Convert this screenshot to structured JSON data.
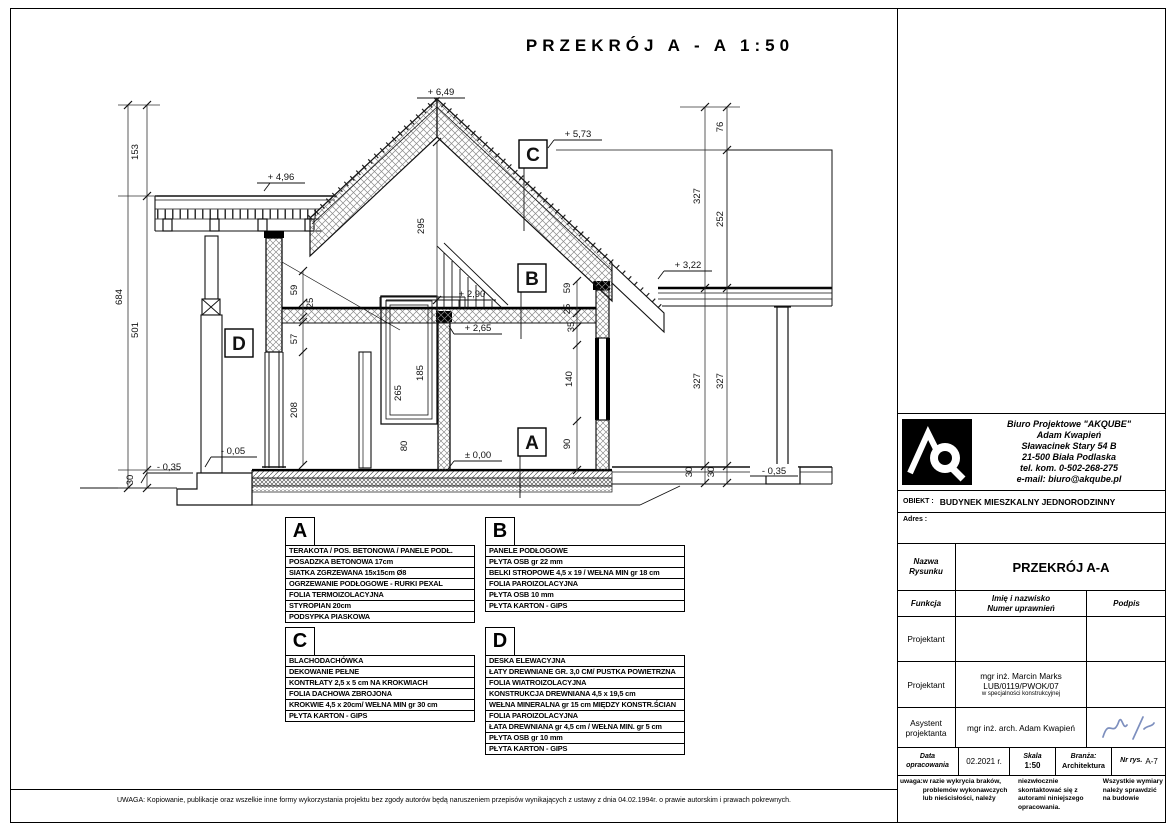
{
  "page": {
    "title": "PRZEKRÓJ  A - A    1:50",
    "footer_note": "UWAGA: Kopiowanie, publikacje oraz wszelkie inne formy wykorzystania projektu bez zgody autorów będą naruszeniem przepisów wynikających z ustawy z dnia 04.02.1994r. o prawie autorskim i prawach pokrewnych."
  },
  "drawing": {
    "callouts": [
      {
        "letter": "A",
        "x": 518,
        "y": 428
      },
      {
        "letter": "B",
        "x": 518,
        "y": 264
      },
      {
        "letter": "C",
        "x": 519,
        "y": 140
      },
      {
        "letter": "D",
        "x": 225,
        "y": 329
      }
    ],
    "labels": [
      {
        "t": "+ 6,49",
        "x": 441,
        "y": 95
      },
      {
        "t": "+ 5,73",
        "x": 578,
        "y": 137
      },
      {
        "t": "+ 4,96",
        "x": 281,
        "y": 180
      },
      {
        "t": "+ 3,22",
        "x": 688,
        "y": 268
      },
      {
        "t": "+ 2,90",
        "x": 472,
        "y": 297
      },
      {
        "t": "+ 2,65",
        "x": 478,
        "y": 331
      },
      {
        "t": "± 0,00",
        "x": 478,
        "y": 458
      },
      {
        "t": "- 0,05",
        "x": 233,
        "y": 454
      },
      {
        "t": "- 0,35",
        "x": 169,
        "y": 470
      },
      {
        "t": "- 0,35",
        "x": 774,
        "y": 474
      },
      {
        "t": "153",
        "x": 138,
        "y": 152,
        "r": -90
      },
      {
        "t": "684",
        "x": 122,
        "y": 297,
        "r": -90
      },
      {
        "t": "501",
        "x": 138,
        "y": 330,
        "r": -90
      },
      {
        "t": "30",
        "x": 133,
        "y": 480,
        "r": -90
      },
      {
        "t": "295",
        "x": 424,
        "y": 226,
        "r": -90
      },
      {
        "t": "59",
        "x": 297,
        "y": 290,
        "r": -90
      },
      {
        "t": "25",
        "x": 313,
        "y": 303,
        "r": -90
      },
      {
        "t": "57",
        "x": 297,
        "y": 339,
        "r": -90
      },
      {
        "t": "208",
        "x": 297,
        "y": 410,
        "r": -90
      },
      {
        "t": "265",
        "x": 401,
        "y": 393,
        "r": -90
      },
      {
        "t": "185",
        "x": 423,
        "y": 373,
        "r": -90
      },
      {
        "t": "80",
        "x": 407,
        "y": 446,
        "r": -90
      },
      {
        "t": "90",
        "x": 570,
        "y": 444,
        "r": -90
      },
      {
        "t": "140",
        "x": 572,
        "y": 379,
        "r": -90
      },
      {
        "t": "59",
        "x": 570,
        "y": 288,
        "r": -90
      },
      {
        "t": "25",
        "x": 570,
        "y": 309,
        "r": -90
      },
      {
        "t": "35",
        "x": 574,
        "y": 327,
        "r": -90
      },
      {
        "t": "327",
        "x": 700,
        "y": 196,
        "r": -90
      },
      {
        "t": "76",
        "x": 723,
        "y": 127,
        "r": -90
      },
      {
        "t": "252",
        "x": 723,
        "y": 219,
        "r": -90
      },
      {
        "t": "327",
        "x": 700,
        "y": 381,
        "r": -90
      },
      {
        "t": "327",
        "x": 723,
        "y": 381,
        "r": -90
      },
      {
        "t": "30",
        "x": 692,
        "y": 472,
        "r": -90
      },
      {
        "t": "30",
        "x": 714,
        "y": 472,
        "r": -90
      }
    ]
  },
  "legend": {
    "tables": [
      {
        "letter": "A",
        "rows": [
          "TERAKOTA / POS. BETONOWA / PANELE PODŁ.",
          "POSADZKA BETONOWA 17cm",
          "SIATKA ZGRZEWANA 15x15cm Ø8",
          "OGRZEWANIE PODŁOGOWE - RURKI PEXAL",
          "FOLIA TERMOIZOLACYJNA",
          "STYROPIAN 20cm",
          "PODSYPKA PIASKOWA"
        ]
      },
      {
        "letter": "B",
        "rows": [
          "PANELE PODŁOGOWE",
          "PŁYTA OSB gr 22 mm",
          "BELKI STROPOWE  4,5 x 19 / WEŁNA MIN gr 18 cm",
          "FOLIA PAROIZOLACYJNA",
          "PŁYTA OSB 10 mm",
          "PŁYTA KARTON - GIPS"
        ]
      },
      {
        "letter": "C",
        "rows": [
          "BLACHODACHÓWKA",
          "DEKOWANIE PEŁNE",
          "KONTRŁATY 2,5 x 5 cm NA KROKWIACH",
          "FOLIA DACHOWA ZBROJONA",
          "KROKWIE 4,5 x 20cm/ WEŁNA MIN gr 30 cm",
          "PŁYTA KARTON - GIPS"
        ]
      },
      {
        "letter": "D",
        "rows": [
          "DESKA ELEWACYJNA",
          "ŁATY DREWNIANE GR. 3,0 CM/ PUSTKA POWIETRZNA",
          "FOLIA WIATROIZOLACYJNA",
          "KONSTRUKCJA DREWNIANA 4,5 x 19,5 cm",
          "WEŁNA MINERALNA gr 15 cm MIĘDZY KONSTR.ŚCIAN",
          "FOLIA PAROIZOLACYJNA",
          "ŁATA DREWNIANA gr 4,5 cm / WEŁNA MIN. gr 5 cm",
          "PŁYTA OSB gr 10 mm",
          "PŁYTA KARTON - GIPS"
        ]
      }
    ]
  },
  "title_block": {
    "logo_text": "AQ",
    "company_name": "Biuro Projektowe \"AKQUBE\"",
    "company_person": "Adam Kwapień",
    "company_addr1": "Sławacinek Stary 54 B",
    "company_addr2": "21-500 Biała Podlaska",
    "company_tel": "tel. kom. 0-502-268-275",
    "company_email": "e-mail: biuro@akqube.pl",
    "obiekt_label": "OBIEKT :",
    "obiekt_value": "BUDYNEK MIESZKALNY JEDNORODZINNY",
    "adres_label": "Adres :",
    "nazwa_label_1": "Nazwa",
    "nazwa_label_2": "Rysunku",
    "nazwa_value": "PRZEKRÓJ A-A",
    "funkcja_label": "Funkcja",
    "imie_label_1": "Imię i nazwisko",
    "imie_label_2": "Numer uprawnień",
    "podpis_label": "Podpis",
    "row1_funkcja": "Projektant",
    "row2_funkcja": "Projektant",
    "row2_name": "mgr inż. Marcin Marks",
    "row2_upr": "LUB/0119/PWOK/07",
    "row2_spec": "w specjalności konstrukcyjnej",
    "row3_funkcja_1": "Asystent",
    "row3_funkcja_2": "projektanta",
    "row3_name": "mgr inż. arch. Adam Kwapień",
    "data_label_1": "Data",
    "data_label_2": "opracowania",
    "data_value": "02.2021 r.",
    "skala_label": "Skala",
    "skala_value": "1:50",
    "branza_label": "Branża:",
    "branza_value": "Architektura",
    "nr_label": "Nr rys.",
    "nr_value": "A-7",
    "uwaga_1": "uwaga:",
    "uwaga_2": "w razie wykrycia braków, problemów wykonawczych lub nieścisłości, należy",
    "uwaga_3": "niezwłocznie skontaktować się z autorami niniejszego opracowania.",
    "uwaga_4": "Wszystkie wymiary należy sprawdzić na budowie",
    "signature_color": "#7d8fbe"
  }
}
